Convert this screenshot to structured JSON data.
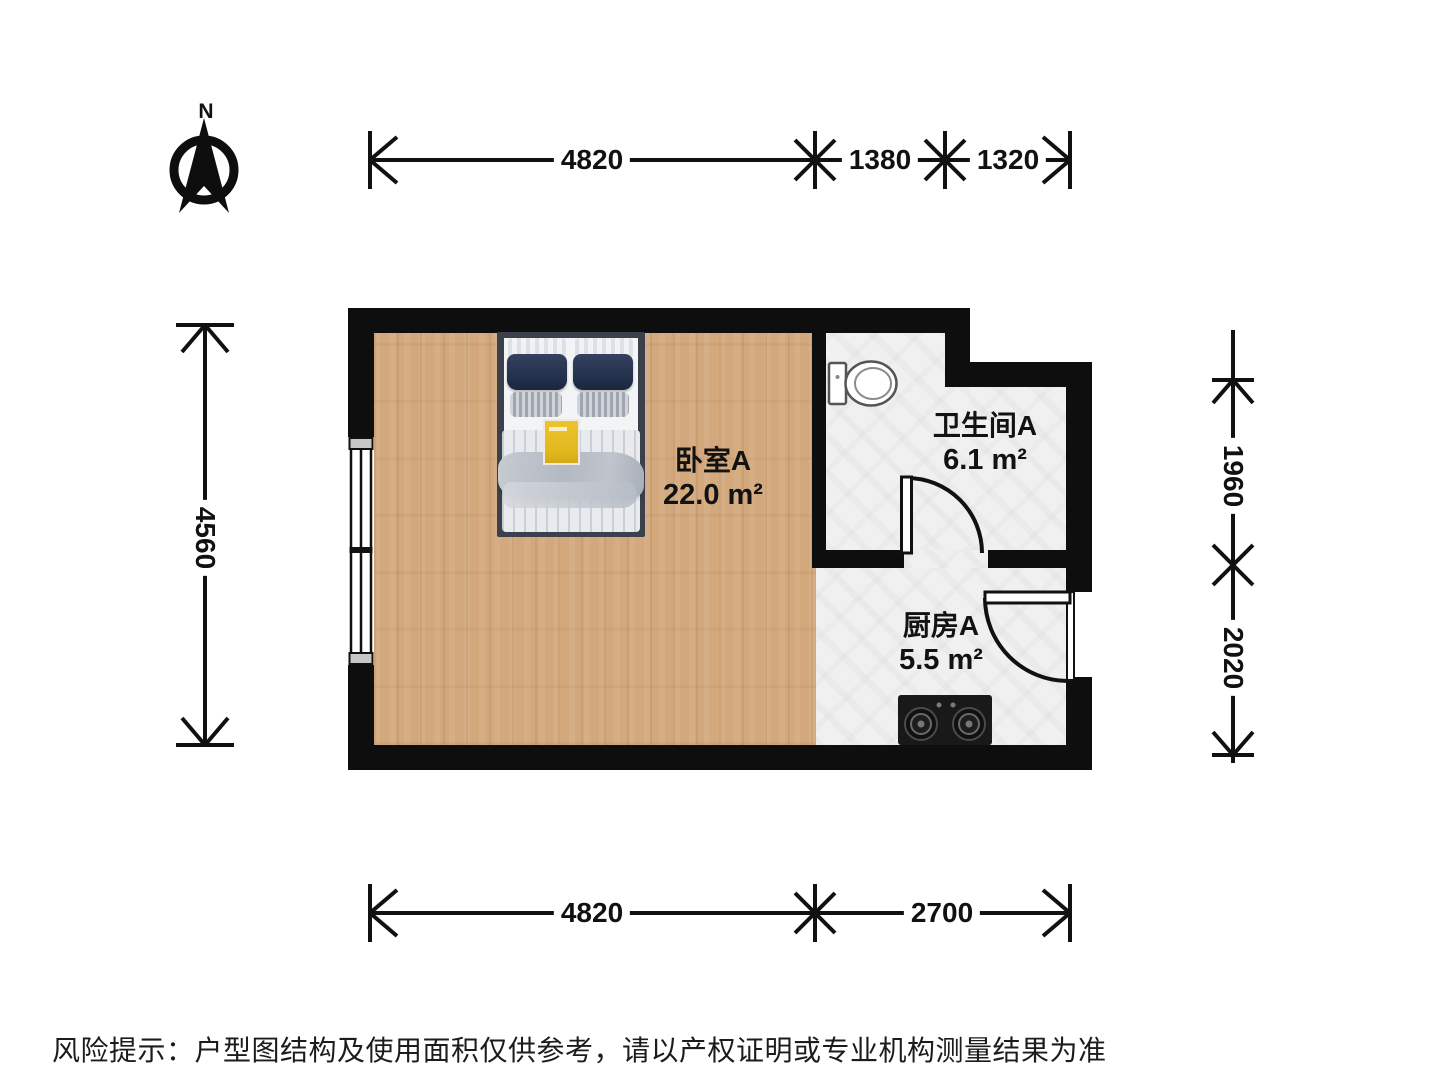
{
  "plan_title": "户型图",
  "north": {
    "label": "N"
  },
  "rooms": [
    {
      "id": "bedroom",
      "name": "卧室A",
      "area": "22.0 m²"
    },
    {
      "id": "bathroom",
      "name": "卫生间A",
      "area": "6.1 m²"
    },
    {
      "id": "kitchen",
      "name": "厨房A",
      "area": "5.5 m²"
    }
  ],
  "dimensions": {
    "top": [
      "4820",
      "1380",
      "1320"
    ],
    "bottom": [
      "4820",
      "2700"
    ],
    "left": [
      "4560"
    ],
    "right": [
      "1960",
      "2020"
    ]
  },
  "disclaimer": {
    "text": "风险提示：户型图结构及使用面积仅供参考，请以产权证明或专业机构测量结果为准"
  },
  "fixtures": [
    "bed",
    "toilet",
    "gas-stove",
    "window",
    "bathroom-door",
    "kitchen-door"
  ],
  "colors": {
    "wall": "#0e0e0e",
    "wood_floor": "#d2a87c",
    "tile_floor": "#f0f0f0",
    "bed_frame": "#3a414c",
    "pillow_navy": "#26334f",
    "accent_yellow": "#e3b81f",
    "text": "#111111"
  }
}
